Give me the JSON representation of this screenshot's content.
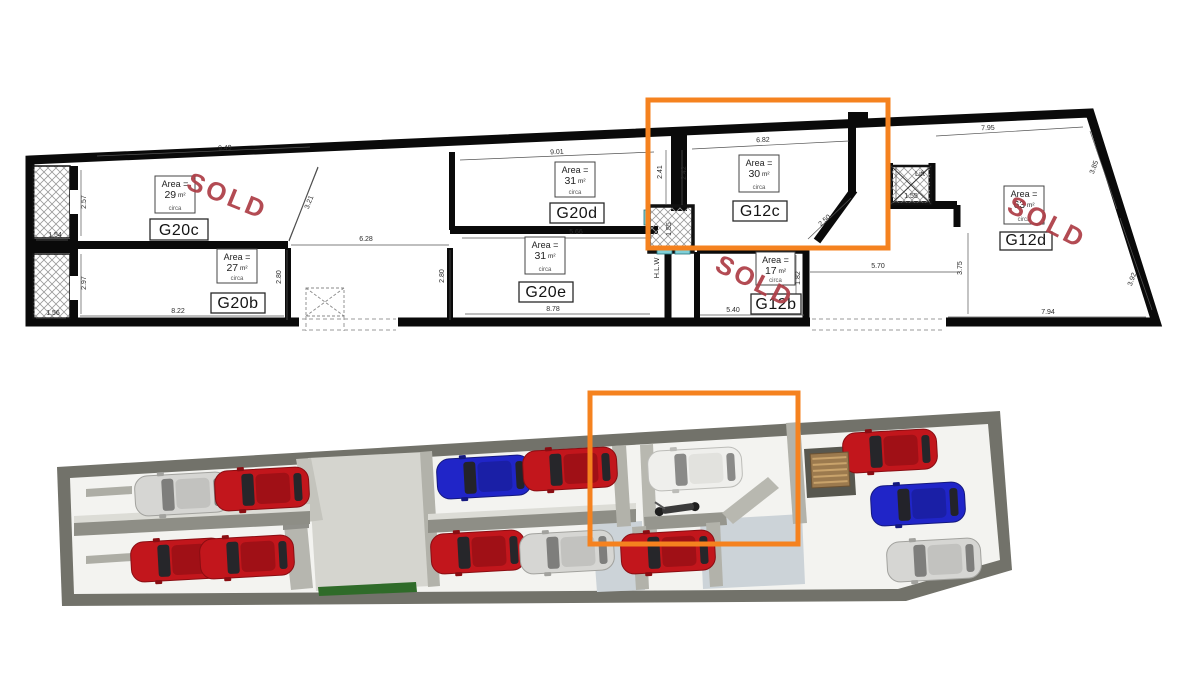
{
  "title": "Garage floor plan with 3D visualisation",
  "plan": {
    "sold_text": "SOLD",
    "sold_color": "#ae3e47",
    "highlight_color": "#f5821f",
    "area_prefix": "Area =",
    "area_note": "circa",
    "unit_suffix": "m²",
    "lift_label": "Lift",
    "shaft_label": "H.L.W",
    "highlight_box": [
      648,
      100,
      240,
      148
    ],
    "units": [
      {
        "name": "G20c",
        "area": "29",
        "label_box": [
          150,
          219,
          58,
          21
        ],
        "area_box": [
          155,
          176,
          40,
          37
        ],
        "sold": {
          "x": 224,
          "y": 204,
          "rot": 22
        }
      },
      {
        "name": "G20b",
        "area": "27",
        "label_box": [
          211,
          293,
          54,
          20
        ],
        "area_box": [
          217,
          249,
          40,
          34
        ]
      },
      {
        "name": "G20d",
        "area": "31",
        "label_box": [
          550,
          203,
          54,
          20
        ],
        "area_box": [
          555,
          162,
          40,
          35
        ]
      },
      {
        "name": "G20e",
        "area": "31",
        "label_box": [
          519,
          282,
          54,
          20
        ],
        "area_box": [
          525,
          237,
          40,
          37
        ]
      },
      {
        "name": "G12c",
        "area": "30",
        "label_box": [
          733,
          201,
          54,
          20
        ],
        "area_box": [
          739,
          155,
          40,
          37
        ]
      },
      {
        "name": "G12b",
        "area": "17",
        "label_box": [
          751,
          294,
          50,
          20
        ],
        "area_box": [
          756,
          252,
          39,
          33
        ],
        "sold": {
          "x": 751,
          "y": 289,
          "rot": 27
        }
      },
      {
        "name": "G12d",
        "area": "63",
        "label_box": [
          1000,
          232,
          52,
          18
        ],
        "area_box": [
          1004,
          186,
          40,
          38
        ],
        "sold": {
          "x": 1043,
          "y": 230,
          "rot": 27
        }
      }
    ],
    "dims": [
      {
        "t": "9.49",
        "x": 225,
        "y": 150,
        "r": -3,
        "l": [
          97,
          156,
          310,
          147
        ]
      },
      {
        "t": "3.21",
        "x": 311,
        "y": 203,
        "r": -68,
        "l": [
          318,
          168,
          289,
          240
        ]
      },
      {
        "t": "2.57",
        "x": 86,
        "y": 202,
        "r": -90,
        "l": [
          81,
          170,
          81,
          236
        ]
      },
      {
        "t": "1.54",
        "x": 55,
        "y": 237,
        "r": 0,
        "l": [
          36,
          240,
          68,
          240
        ]
      },
      {
        "t": "2.97",
        "x": 86,
        "y": 283,
        "r": -90,
        "l": [
          81,
          254,
          81,
          314
        ]
      },
      {
        "t": "1.56",
        "x": 53,
        "y": 315,
        "r": 0,
        "l": [
          36,
          318,
          66,
          318
        ]
      },
      {
        "t": "8.22",
        "x": 178,
        "y": 313,
        "r": 0,
        "l": [
          80,
          316,
          284,
          316
        ]
      },
      {
        "t": "6.28",
        "x": 366,
        "y": 241,
        "r": 0,
        "l": [
          291,
          245,
          449,
          245
        ]
      },
      {
        "t": "2.80",
        "x": 281,
        "y": 277,
        "r": -90,
        "l": [
          287,
          250,
          287,
          320
        ]
      },
      {
        "t": "2.80",
        "x": 444,
        "y": 276,
        "r": -90,
        "l": [
          450,
          250,
          450,
          320
        ]
      },
      {
        "t": "9.01",
        "x": 557,
        "y": 154,
        "r": -3,
        "l": [
          460,
          160,
          654,
          152
        ]
      },
      {
        "t": "5.66",
        "x": 576,
        "y": 234,
        "r": 0,
        "l": [
          462,
          238,
          652,
          238
        ]
      },
      {
        "t": "8.78",
        "x": 553,
        "y": 311,
        "r": 0,
        "l": [
          465,
          314,
          650,
          314
        ]
      },
      {
        "t": "2.41",
        "x": 662,
        "y": 172,
        "r": -90,
        "l": [
          666,
          150,
          666,
          205
        ]
      },
      {
        "t": "2.42",
        "x": 686,
        "y": 173,
        "r": -90,
        "l": [
          682,
          150,
          682,
          205
        ]
      },
      {
        "t": "1.55",
        "x": 671,
        "y": 229,
        "r": -90
      },
      {
        "t": "6.82",
        "x": 763,
        "y": 142,
        "r": -2,
        "l": [
          692,
          149,
          849,
          141
        ]
      },
      {
        "t": "2.50",
        "x": 826,
        "y": 222,
        "r": -42,
        "l": [
          808,
          239,
          851,
          198
        ]
      },
      {
        "t": "1.82",
        "x": 800,
        "y": 278,
        "r": -90,
        "l": [
          796,
          255,
          796,
          300
        ]
      },
      {
        "t": "5.40",
        "x": 733,
        "y": 312,
        "r": 0,
        "l": [
          700,
          315,
          804,
          315
        ]
      },
      {
        "t": "5.70",
        "x": 878,
        "y": 268,
        "r": 0,
        "l": [
          810,
          272,
          960,
          272
        ]
      },
      {
        "t": "3.75",
        "x": 962,
        "y": 268,
        "r": -90,
        "l": [
          968,
          233,
          968,
          314
        ]
      },
      {
        "t": "7.94",
        "x": 1048,
        "y": 314,
        "r": 0,
        "l": [
          948,
          317,
          1146,
          317
        ]
      },
      {
        "t": "7.95",
        "x": 988,
        "y": 130,
        "r": -2,
        "l": [
          936,
          136,
          1083,
          127
        ]
      },
      {
        "t": "3.85",
        "x": 1096,
        "y": 168,
        "r": -70,
        "l": [
          1090,
          131,
          1117,
          209
        ]
      },
      {
        "t": "3.92",
        "x": 1134,
        "y": 280,
        "r": -70,
        "l": [
          1120,
          218,
          1152,
          310
        ]
      },
      {
        "t": "1.50",
        "x": 892,
        "y": 184,
        "r": -90,
        "l": [
          896,
          168,
          896,
          200
        ]
      },
      {
        "t": "1.55",
        "x": 911,
        "y": 198,
        "r": 0,
        "l": [
          894,
          202,
          928,
          202
        ]
      }
    ],
    "texts": [
      {
        "t": "Lift",
        "x": 920,
        "y": 176,
        "r": 0,
        "size": 7.5
      },
      {
        "t": "H.L.W",
        "x": 659,
        "y": 268,
        "r": -90,
        "size": 7.5
      }
    ]
  },
  "view3d": {
    "highlight_box": [
      590,
      393,
      208,
      151
    ],
    "shapes": [
      {
        "n": "outer-walls",
        "f": "#72726a",
        "p": [
          [
            57,
            467
          ],
          [
            1000,
            411
          ],
          [
            1012,
            570
          ],
          [
            906,
            601
          ],
          [
            62,
            606
          ]
        ]
      },
      {
        "n": "floor",
        "f": "#f3f3f0",
        "p": [
          [
            70,
            478
          ],
          [
            988,
            424
          ],
          [
            1000,
            560
          ],
          [
            898,
            589
          ],
          [
            74,
            594
          ]
        ]
      },
      {
        "n": "aisle-left",
        "f": "#ccd3d8",
        "p": [
          [
            592,
            524
          ],
          [
            642,
            521
          ],
          [
            645,
            590
          ],
          [
            597,
            592
          ]
        ]
      },
      {
        "n": "aisle-right",
        "f": "#ccd3d8",
        "p": [
          [
            700,
            520
          ],
          [
            802,
            514
          ],
          [
            805,
            584
          ],
          [
            703,
            589
          ]
        ]
      },
      {
        "n": "ramp",
        "f": "#d5d5cf",
        "p": [
          [
            308,
            458
          ],
          [
            424,
            452
          ],
          [
            432,
            586
          ],
          [
            316,
            591
          ]
        ]
      },
      {
        "n": "ramp-wall-upper",
        "f": "#c4c4bd",
        "p": [
          [
            296,
            459
          ],
          [
            311,
            458
          ],
          [
            323,
            520
          ],
          [
            307,
            522
          ]
        ]
      },
      {
        "n": "ramp-wall-lower",
        "f": "#b6b6af",
        "p": [
          [
            284,
            526
          ],
          [
            307,
            524
          ],
          [
            313,
            588
          ],
          [
            291,
            590
          ]
        ]
      },
      {
        "n": "ramp-wall-stub",
        "f": "#90908a",
        "p": [
          [
            283,
            515
          ],
          [
            309,
            513
          ],
          [
            309,
            528
          ],
          [
            283,
            530
          ]
        ]
      },
      {
        "n": "section2-left-wall",
        "f": "#b2b2aa",
        "p": [
          [
            420,
            452
          ],
          [
            432,
            451
          ],
          [
            440,
            586
          ],
          [
            428,
            587
          ]
        ]
      },
      {
        "n": "midwall1-top",
        "f": "#dcdcd6",
        "p": [
          [
            74,
            516
          ],
          [
            310,
            504
          ],
          [
            310,
            512
          ],
          [
            74,
            524
          ]
        ]
      },
      {
        "n": "midwall1-face",
        "f": "#8e8e86",
        "p": [
          [
            74,
            523
          ],
          [
            310,
            511
          ],
          [
            310,
            524
          ],
          [
            74,
            536
          ]
        ]
      },
      {
        "n": "midwall2-top",
        "f": "#dcdcd6",
        "p": [
          [
            428,
            514
          ],
          [
            636,
            503
          ],
          [
            636,
            510
          ],
          [
            428,
            521
          ]
        ]
      },
      {
        "n": "midwall2-face",
        "f": "#8e8e86",
        "p": [
          [
            428,
            520
          ],
          [
            636,
            509
          ],
          [
            636,
            522
          ],
          [
            428,
            533
          ]
        ]
      },
      {
        "n": "wall-2-3",
        "f": "#b2b2aa",
        "p": [
          [
            612,
            446
          ],
          [
            626,
            445
          ],
          [
            631,
            526
          ],
          [
            617,
            527
          ]
        ]
      },
      {
        "n": "g12c-left-wall",
        "f": "#b8b8b0",
        "p": [
          [
            640,
            445
          ],
          [
            653,
            444
          ],
          [
            657,
            532
          ],
          [
            644,
            533
          ]
        ]
      },
      {
        "n": "g12c-bottom-stub",
        "f": "#96968e",
        "p": [
          [
            644,
            517
          ],
          [
            726,
            512
          ],
          [
            727,
            525
          ],
          [
            645,
            530
          ]
        ]
      },
      {
        "n": "g12c-chamfer-wall",
        "f": "#b8b8b0",
        "p": [
          [
            722,
            513
          ],
          [
            768,
            477
          ],
          [
            779,
            488
          ],
          [
            733,
            524
          ]
        ]
      },
      {
        "n": "wall-3-4",
        "f": "#b2b2aa",
        "p": [
          [
            786,
            423
          ],
          [
            800,
            422
          ],
          [
            807,
            523
          ],
          [
            793,
            524
          ]
        ]
      },
      {
        "n": "lift-nook",
        "f": "#57574f",
        "p": [
          [
            804,
            449
          ],
          [
            853,
            446
          ],
          [
            856,
            495
          ],
          [
            807,
            498
          ]
        ]
      },
      {
        "n": "g12b-left-wall",
        "f": "#b2b2aa",
        "p": [
          [
            632,
            527
          ],
          [
            646,
            526
          ],
          [
            649,
            589
          ],
          [
            636,
            590
          ]
        ]
      },
      {
        "n": "g12b-right-wall",
        "f": "#b2b2aa",
        "p": [
          [
            706,
            523
          ],
          [
            720,
            522
          ],
          [
            723,
            586
          ],
          [
            710,
            587
          ]
        ]
      },
      {
        "n": "hedge",
        "f": "#2f6b29",
        "p": [
          [
            318,
            587
          ],
          [
            416,
            582
          ],
          [
            417,
            592
          ],
          [
            319,
            596
          ]
        ]
      },
      {
        "n": "door-bar-1",
        "f": "#adada5",
        "p": [
          [
            86,
            489
          ],
          [
            132,
            486
          ],
          [
            132,
            494
          ],
          [
            86,
            497
          ]
        ]
      },
      {
        "n": "door-bar-2",
        "f": "#adada5",
        "p": [
          [
            86,
            556
          ],
          [
            132,
            553
          ],
          [
            132,
            561
          ],
          [
            86,
            564
          ]
        ]
      }
    ],
    "car_colors": {
      "red": {
        "body": "#c2161c",
        "edge": "#8a0d12",
        "roof": "#a01016",
        "glass": "#26262a"
      },
      "blue": {
        "body": "#2025c8",
        "edge": "#14187f",
        "roof": "#1a1fa6",
        "glass": "#23232a"
      },
      "silver": {
        "body": "#d6d6d3",
        "edge": "#a2a29e",
        "roof": "#c2c2bf",
        "glass": "#7e7e7c"
      },
      "white": {
        "body": "#efefec",
        "edge": "#bcbcb8",
        "roof": "#e2e2de",
        "glass": "#8a8a88"
      }
    },
    "cars": [
      {
        "x": 182,
        "y": 494,
        "c": "silver"
      },
      {
        "x": 262,
        "y": 489,
        "c": "red"
      },
      {
        "x": 178,
        "y": 560,
        "c": "red"
      },
      {
        "x": 247,
        "y": 557,
        "c": "red"
      },
      {
        "x": 484,
        "y": 477,
        "c": "blue"
      },
      {
        "x": 570,
        "y": 469,
        "c": "red"
      },
      {
        "x": 478,
        "y": 552,
        "c": "red"
      },
      {
        "x": 567,
        "y": 552,
        "c": "silver"
      },
      {
        "x": 695,
        "y": 469,
        "c": "white"
      },
      {
        "x": 668,
        "y": 552,
        "c": "red"
      },
      {
        "x": 890,
        "y": 451,
        "c": "red"
      },
      {
        "x": 918,
        "y": 504,
        "c": "blue"
      },
      {
        "x": 934,
        "y": 560,
        "c": "silver"
      }
    ],
    "stairs": {
      "x": 830,
      "y": 470
    },
    "bike": {
      "x": 678,
      "y": 508
    }
  }
}
